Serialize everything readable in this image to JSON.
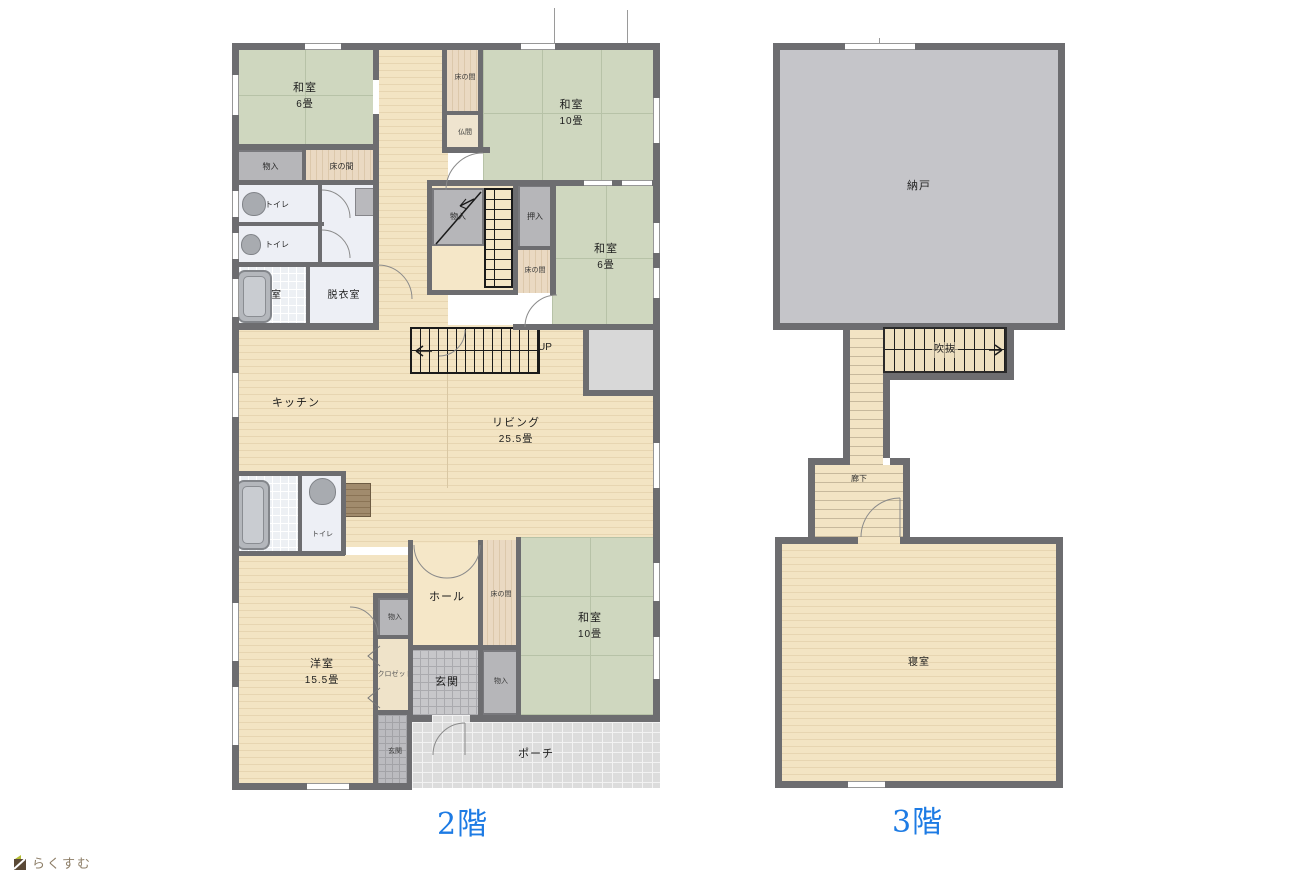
{
  "floor2": {
    "title": "2階",
    "rooms": {
      "washitsu6_tl": {
        "label": "和室",
        "size": "6畳"
      },
      "monoire_tl": {
        "label": "物入"
      },
      "tokonoma_tl": {
        "label": "床の間"
      },
      "toilet1": {
        "label": "トイレ"
      },
      "toilet2": {
        "label": "トイレ"
      },
      "bathroom": {
        "label": "浴室"
      },
      "datsuishitsu": {
        "label": "脱衣室"
      },
      "tokonoma_top": {
        "label": "床の間"
      },
      "butsuma": {
        "label": "仏間"
      },
      "washitsu10_tr": {
        "label": "和室",
        "size": "10畳"
      },
      "monoire_stairs": {
        "label": "物入"
      },
      "oshiire": {
        "label": "押入"
      },
      "tokonoma_mid": {
        "label": "床の間"
      },
      "washitsu6_r": {
        "label": "和室",
        "size": "6畳"
      },
      "stairs_up": {
        "label": "UP"
      },
      "kitchen": {
        "label": "キッチン"
      },
      "living": {
        "label": "リビング",
        "size": "25.5畳"
      },
      "toilet3": {
        "label": "トイレ"
      },
      "youshitsu": {
        "label": "洋室",
        "size": "15.5畳"
      },
      "hall": {
        "label": "ホール"
      },
      "tokonoma_btm": {
        "label": "床の間"
      },
      "washitsu10_b": {
        "label": "和室",
        "size": "10畳"
      },
      "monoire_hall": {
        "label": "物入"
      },
      "closet": {
        "label": "クロゼット"
      },
      "genkan_inner": {
        "label": "玄関"
      },
      "monoire_entry": {
        "label": "物入"
      },
      "genkan_outer": {
        "label": "玄関"
      },
      "porch": {
        "label": "ポーチ"
      }
    }
  },
  "floor3": {
    "title": "3階",
    "rooms": {
      "nando": {
        "label": "納戸"
      },
      "fukinuke": {
        "label": "吹抜"
      },
      "rouka": {
        "label": "廊下"
      },
      "shinshitsu": {
        "label": "寝室"
      }
    }
  },
  "logo": {
    "text": "らくすむ"
  },
  "colors": {
    "wall": "#6d6d70",
    "tatami": "#cfd7bf",
    "wood": "#f3e4c3",
    "title_blue": "#1d7be4"
  }
}
